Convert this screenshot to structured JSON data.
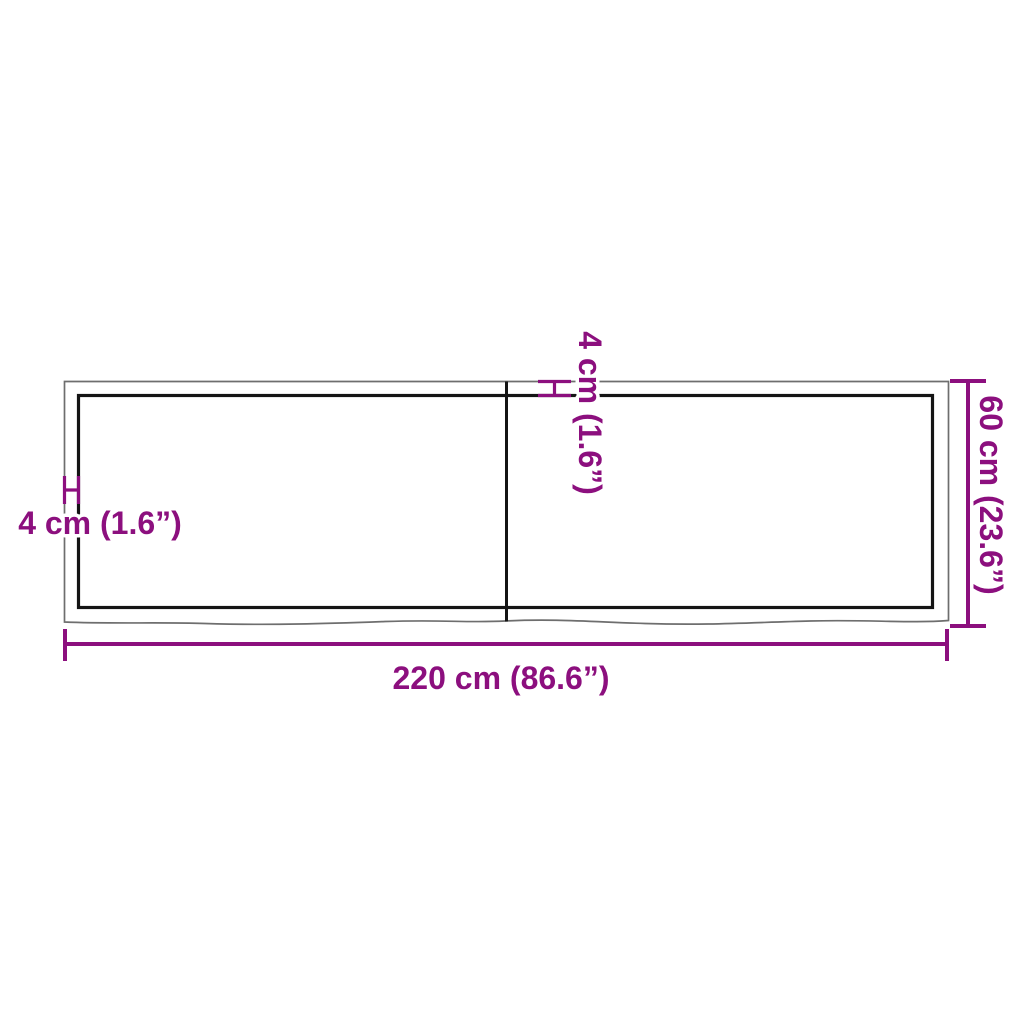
{
  "diagram": {
    "labels": {
      "edge_thickness_left": "4 cm (1.6”)",
      "edge_thickness_top": "4 cm (1.6”)",
      "depth": "60 cm (23.6”)",
      "width": "220 cm (86.6”)"
    },
    "dimensions": {
      "width_cm": 220,
      "width_in": 86.6,
      "depth_cm": 60,
      "depth_in": 23.6,
      "edge_thickness_cm": 4,
      "edge_thickness_in": 1.6
    },
    "colors": {
      "dimension_accent": "#8c0f7e",
      "outline_gray": "#6e6e6e",
      "panel_black": "#141414",
      "background": "#ffffff"
    }
  }
}
